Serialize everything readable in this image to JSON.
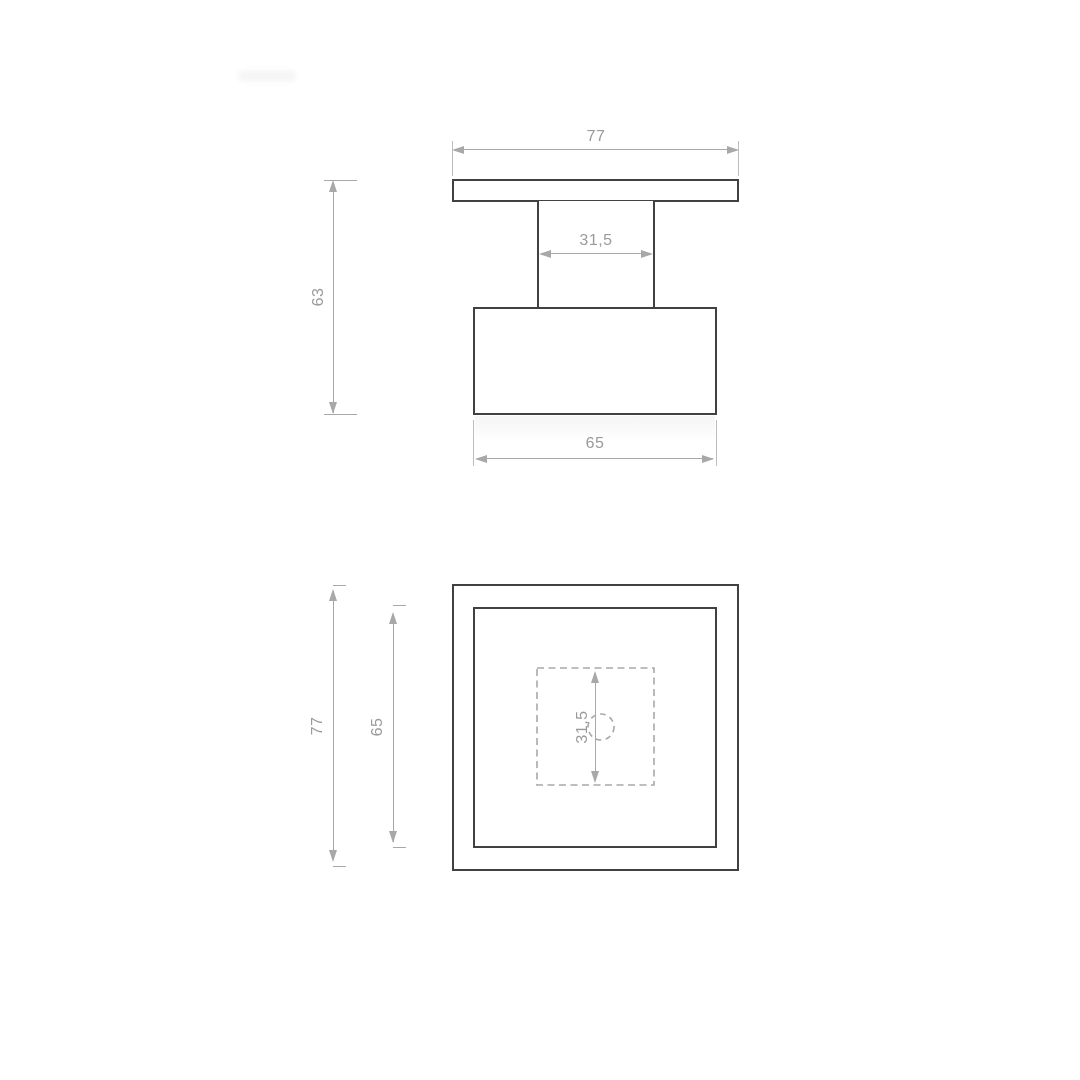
{
  "colors": {
    "part_outline": "#414141",
    "dimension_line": "#a8a8a8",
    "dimension_text": "#9a9a9a",
    "background": "#ffffff"
  },
  "side_view": {
    "dim_plate_width": "77",
    "dim_overall_height": "63",
    "dim_stem_width": "31,5",
    "dim_body_width": "65"
  },
  "top_view": {
    "dim_outer_width": "77",
    "dim_inner_width": "65",
    "dim_hole_span": "31,5"
  }
}
